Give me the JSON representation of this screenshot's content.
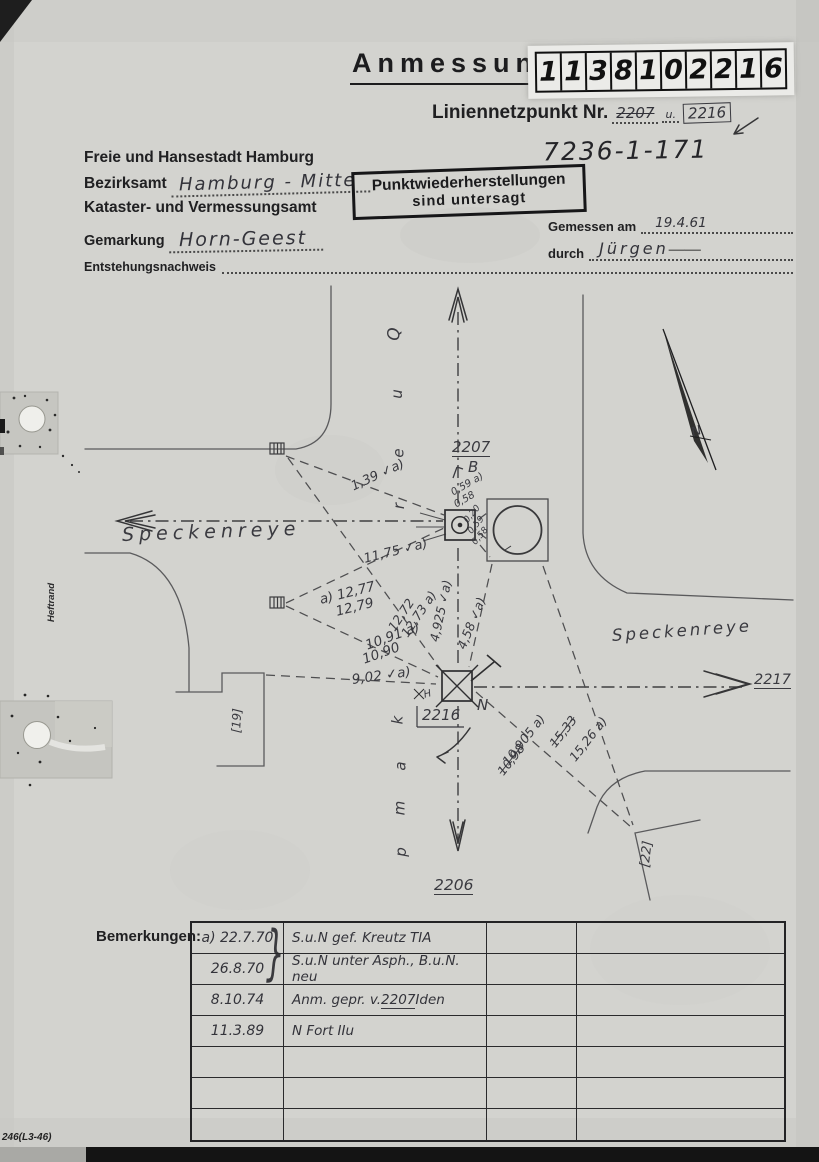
{
  "header": {
    "title": "Anmessung",
    "digits": [
      "1",
      "1",
      "3",
      "8",
      "1",
      "0",
      "2",
      "2",
      "1",
      "6"
    ],
    "liniennetzpunkt_label": "Liniennetzpunkt Nr.",
    "old_point": "2207",
    "connector": "u.",
    "new_point": "2216",
    "file_number": "7236-1-171"
  },
  "office": {
    "line1": "Freie und Hansestadt Hamburg",
    "bezirksamt_label": "Bezirksamt",
    "bezirksamt_value": "Hamburg - Mitte",
    "line3": "Kataster- und Vermessungsamt",
    "gemarkung_label": "Gemarkung",
    "gemarkung_value": "Horn-Geest",
    "entstehungsnachweis_label": "Entstehungsnachweis"
  },
  "stamp": {
    "line1": "Punktwiederherstellungen",
    "line2": "sind untersagt"
  },
  "survey": {
    "gemessen_label": "Gemessen am",
    "gemessen_value": "19.4.61",
    "durch_label": "durch",
    "durch_value": "Jürgen"
  },
  "sketch": {
    "street_west": "Speckenreye",
    "street_east": "Speckenreye",
    "quer_letters": [
      "Q",
      "u",
      "e",
      "r"
    ],
    "kamp_letters": [
      "k",
      "a",
      "m",
      "p"
    ],
    "point_north": "2207",
    "point_center": "2216",
    "point_south": "2206",
    "point_east": "2217",
    "mark_b": "B",
    "mark_n": "N",
    "mark_h": "H",
    "north_letter": "N",
    "parcel_left": "[19]",
    "parcel_right": "[22]",
    "heftrand": "Heftrand",
    "labels": [
      {
        "text": "1,39 ✓a)"
      },
      {
        "text": "0,59 a)"
      },
      {
        "text": "0,58"
      },
      {
        "text": "0,20"
      },
      {
        "text": "0,59"
      },
      {
        "text": "0,58"
      },
      {
        "text": "11,75 ✓a)"
      },
      {
        "text": "a) 12,77"
      },
      {
        "text": "12,79"
      },
      {
        "text": "12,73 a)"
      },
      {
        "text": "12,72"
      },
      {
        "text": "10,91 a)"
      },
      {
        "text": "10,90"
      },
      {
        "text": "9,02 ✓a)"
      },
      {
        "text": "4,925 ✓a)"
      },
      {
        "text": "4,58 ✓a)"
      },
      {
        "text": "10,905 a)"
      },
      {
        "text": "10,98",
        "struck": true
      },
      {
        "text": "15,26 a)"
      },
      {
        "text": "15,33",
        "struck": true
      }
    ]
  },
  "remarks": {
    "label": "Bemerkungen:",
    "brace": "}",
    "rows": [
      {
        "date": "a) 22.7.70",
        "text": "S.u.N gef. Kreutz TIA"
      },
      {
        "date": "26.8.70",
        "text": "S.u.N unter Asph., B.u.N. neu"
      },
      {
        "date": "8.10.74",
        "text_pre": "Anm. gepr. v. ",
        "text_num": "2207",
        "text_post": " Iden"
      },
      {
        "date": "11.3.89",
        "text": "N Fort IIu"
      }
    ]
  },
  "footer": {
    "form_number": "246(L3-46)"
  }
}
